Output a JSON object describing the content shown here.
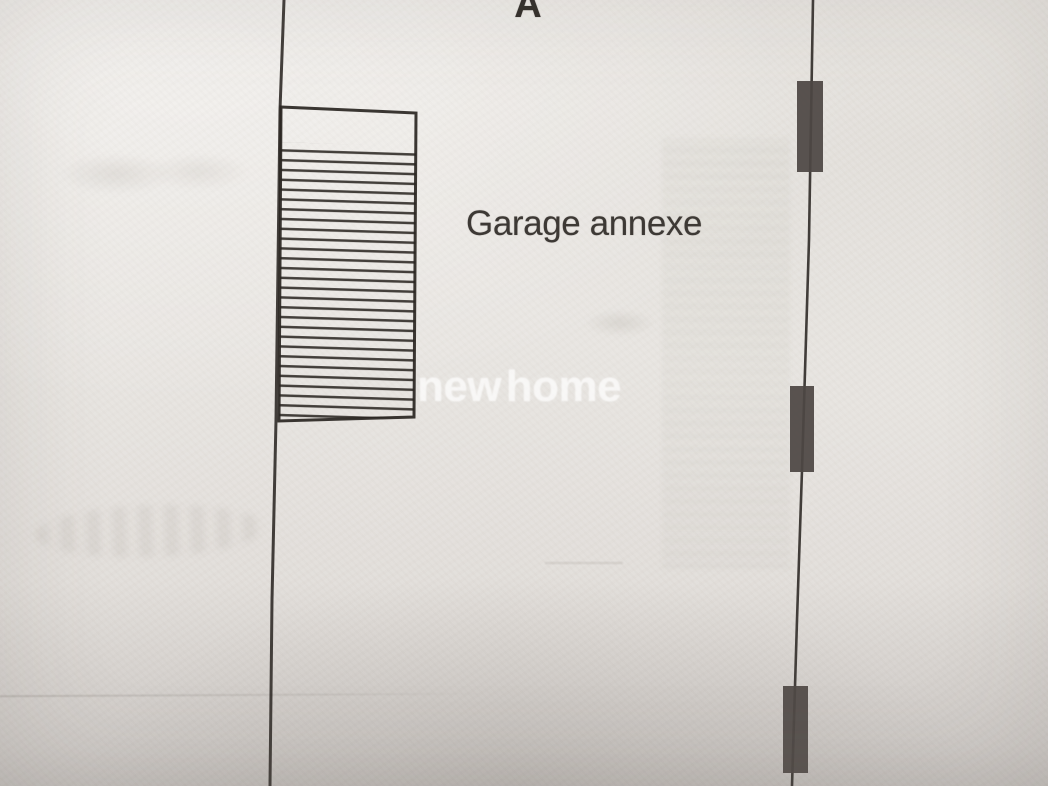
{
  "labels": {
    "section_marker": "A",
    "building": "Garage annexe"
  },
  "watermark": {
    "text": "new home"
  },
  "colors": {
    "paper": "#e9e6e2",
    "ink": "#2a2622",
    "wall_fill": "#4d4744",
    "watermark_white": "rgba(255,255,255,0.60)"
  },
  "plan": {
    "left_boundary": {
      "points": "284,0 280,110 276,420 272,600 270,786"
    },
    "right_boundary": {
      "points": "813,0 809,240 802,470 797,620 792,786"
    },
    "garage": {
      "outline_d": "M281,107 L416,113 L414,417 L279,421 Z",
      "hatch_d": "M281,142 L416,147 L414,417 L279,421 Z"
    },
    "walls": [
      {
        "d": "M797,81 L823,81 L823,172 L797,172 Z"
      },
      {
        "d": "M790,386 L814,386 L814,472 L790,472 Z"
      },
      {
        "d": "M783,686 L808,686 L808,773 L783,773 Z"
      }
    ]
  }
}
